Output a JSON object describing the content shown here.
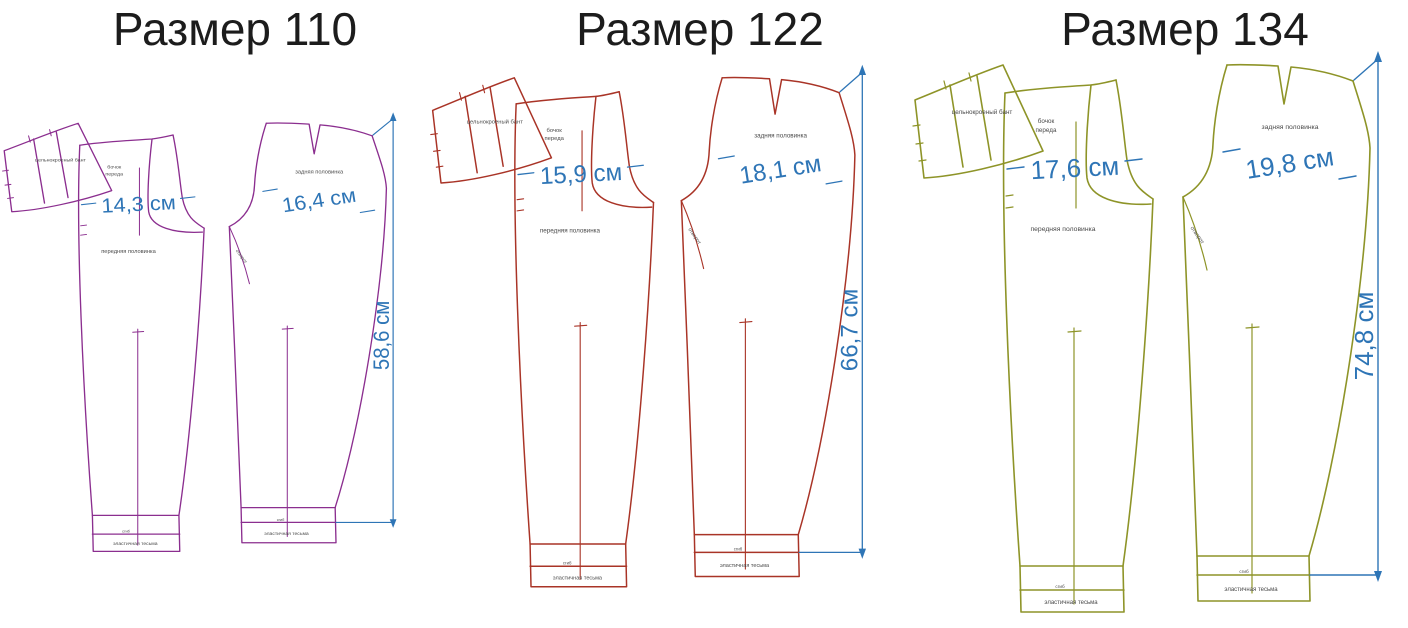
{
  "colors": {
    "size110_outline": "#8b2e8f",
    "size122_outline": "#a93427",
    "size134_outline": "#8e9428",
    "dimension_blue": "#2e75b6",
    "title_text": "#1c1c1c",
    "piece_label_text": "#4a4a4a",
    "background": "#ffffff"
  },
  "piece_labels": {
    "waistband": "цельнокроеный бант",
    "front_side_line1": "бочок",
    "front_side_line2": "переда",
    "front_half": "передняя половинка",
    "back_half": "задняя половинка",
    "fly_line": "отворот",
    "hem_fold": "сгиб",
    "elastic": "эластичная тесьма"
  },
  "patterns": [
    {
      "id": "size-110",
      "title": "Размер 110",
      "front_width": "14,3 см",
      "back_width": "16,4 см",
      "side_length": "58,6 см"
    },
    {
      "id": "size-122",
      "title": "Размер 122",
      "front_width": "15,9 см",
      "back_width": "18,1 см",
      "side_length": "66,7 см"
    },
    {
      "id": "size-134",
      "title": "Размер 134",
      "front_width": "17,6 см",
      "back_width": "19,8 см",
      "side_length": "74,8 см"
    }
  ]
}
